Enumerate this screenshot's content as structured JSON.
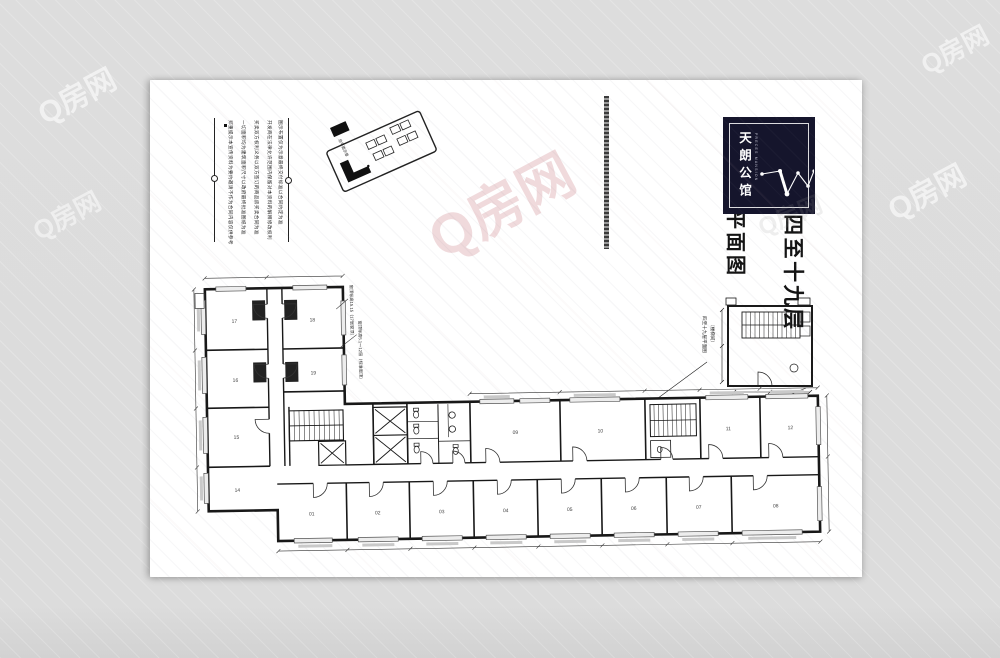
{
  "title": {
    "line1": "C座四至十九层",
    "line2": "平面图"
  },
  "logo": {
    "name": "天朗公馆",
    "tagline": "PRECES MANSION"
  },
  "disclaimer": {
    "columns": [
      "郑重提示本宣传资料为要约邀请不作为合同内容仅供参考",
      "一切面积均为建筑面积尺寸以政府最终批准图纸为准",
      "买卖双方权利义务以双方签订的商品房买卖合同为准",
      "开发商在法律允许范围内保留对本资料的解释修改权利",
      "图示布置仅为示意最终交付标准以合同约定为准"
    ]
  },
  "site_plan": {
    "label": "总平面示意"
  },
  "key_plan": {
    "label": "四至十九层平面图",
    "sublabel": "（楼梯间）"
  },
  "annotations": {
    "a1": "窗顶标高15.15（17层窗顶）",
    "a2": "窗顶标高5.1～12层（标准窗顶）"
  },
  "rooms": {
    "wing": [
      "17",
      "18",
      "16",
      "19",
      "15",
      "14"
    ],
    "top": [
      "09",
      "10",
      "11",
      "12"
    ],
    "bottom": [
      "01",
      "02",
      "03",
      "04",
      "05",
      "06",
      "07",
      "08"
    ]
  },
  "watermark": {
    "text": "Q房网"
  }
}
